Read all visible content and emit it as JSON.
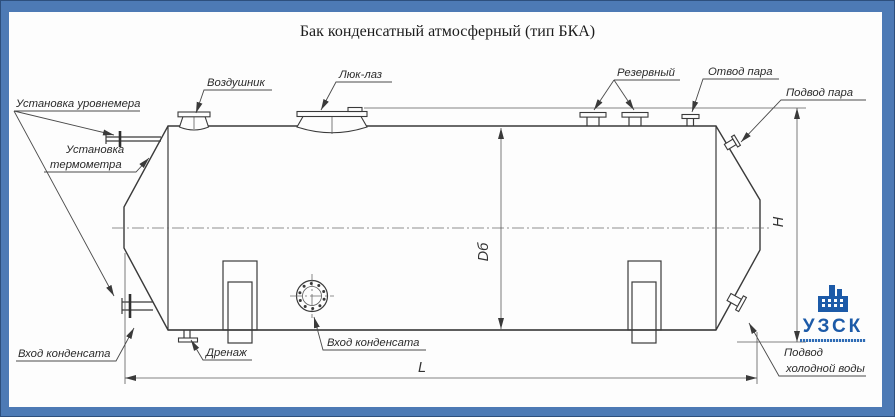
{
  "title": "Бак конденсатный атмосферный (тип БКА)",
  "callouts": {
    "air_vent": "Воздушник",
    "manhole": "Люк-лаз",
    "reserve": "Резервный",
    "steam_outlet": "Отвод пара",
    "steam_supply": "Подвод пара",
    "level_gauge": "Установка уровнемера",
    "thermometer_line1": "Установка",
    "thermometer_line2": "термометра",
    "condensate_inlet_left": "Вход конденсата",
    "drain": "Дренаж",
    "condensate_inlet_center": "Вход конденсата",
    "cold_water_line1": "Подвод",
    "cold_water_line2": "холодной воды"
  },
  "dimensions": {
    "diameter": "Dб",
    "height": "H",
    "length": "L"
  },
  "logo": {
    "name": "УЗСК"
  },
  "colors": {
    "frame_blue": "#4d7ab5",
    "line": "#3a3a3a",
    "logo_blue": "#1c5aa8"
  }
}
